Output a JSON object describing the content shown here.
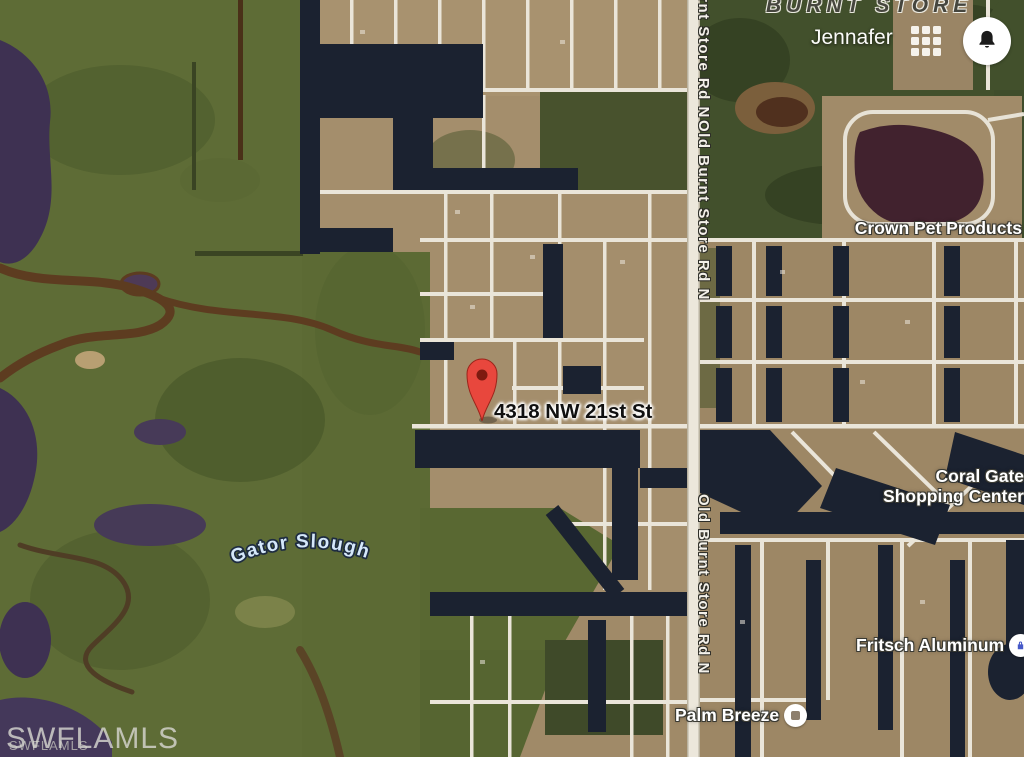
{
  "map": {
    "pin": {
      "label": "4318 NW 21st St",
      "icon": "map-pin"
    },
    "labels": {
      "area": "BURNT STORE",
      "neighborhood": "Jennafer",
      "road": "Old Burnt Store Rd N",
      "water": "Gator Slough",
      "poi_crown": "Crown Pet Products",
      "poi_coral": "Coral Gate Shopping Center",
      "poi_fritsch": "Fritsch Aluminum",
      "poi_palm": "Palm Breeze"
    },
    "watermark": {
      "large": "SWFLAMLS",
      "small": "SWFLAMLS"
    },
    "icons": {
      "apps_grid": "3x3-grid",
      "notification_bell": "bell",
      "fritsch_poi": "blue-business-dot",
      "palm_poi": "gray-square-dot"
    }
  },
  "colors": {
    "marsh_green": "#5e6c36",
    "forest_green": "#42502c",
    "residential_tan": "#a48e6c",
    "street_white": "#eae5d9",
    "canal_navy": "#1b2230",
    "pond_purple": "#3e3152",
    "creek_brown": "#5d3c20",
    "lake_maroon": "#41222e",
    "pin_red": "#e8473d",
    "pin_inner": "#7e1a10",
    "poi_blue": "#4659c8",
    "watermark_gray": "#d6d6d0"
  }
}
